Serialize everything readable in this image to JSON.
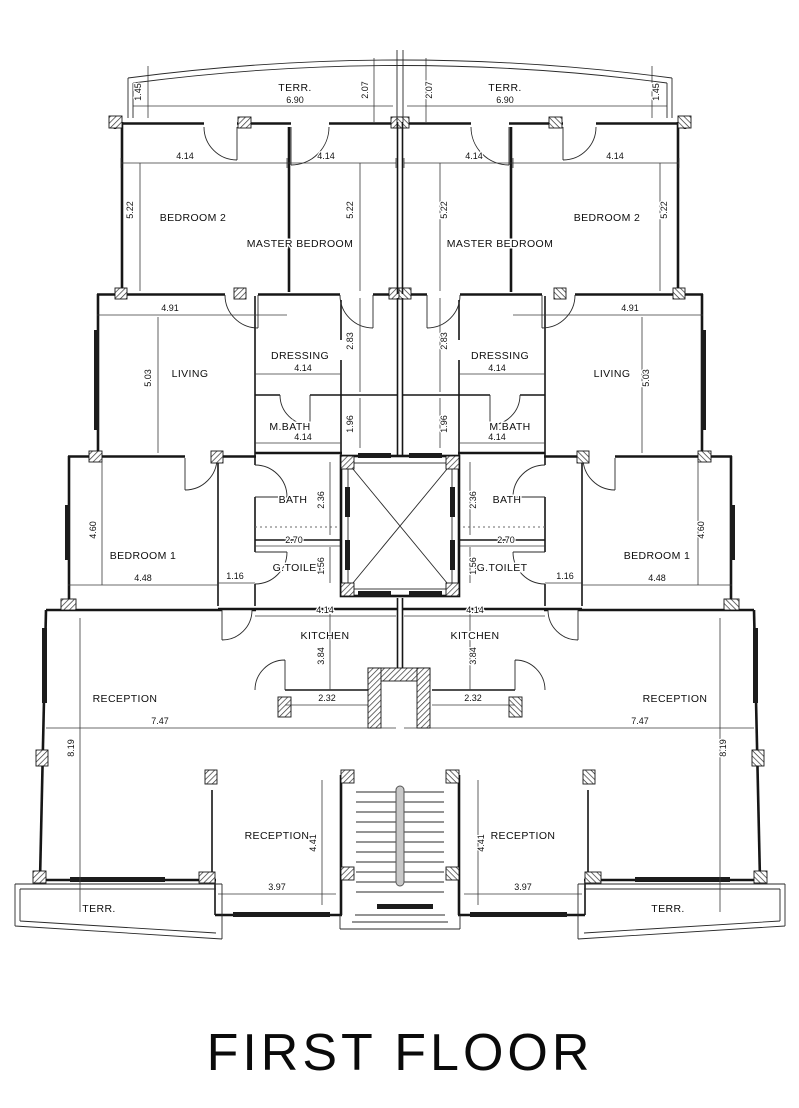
{
  "title": {
    "label": "FIRST FLOOR"
  },
  "colors": {
    "ink": "#161616",
    "paper": "#ffffff",
    "glass": "#1c1c1c"
  },
  "plan": {
    "rooms": [
      {
        "name": "room-label-terrace-top-left",
        "label": "TERR.",
        "x": 295,
        "y": 91
      },
      {
        "name": "room-label-terrace-top-right",
        "label": "TERR.",
        "x": 505,
        "y": 91
      },
      {
        "name": "room-label-bedroom2-left",
        "label": "BEDROOM 2",
        "x": 193,
        "y": 221
      },
      {
        "name": "room-label-bedroom2-right",
        "label": "BEDROOM 2",
        "x": 607,
        "y": 221
      },
      {
        "name": "room-label-master-bedroom-left",
        "label": "MASTER BEDROOM",
        "x": 300,
        "y": 247
      },
      {
        "name": "room-label-master-bedroom-right",
        "label": "MASTER BEDROOM",
        "x": 500,
        "y": 247
      },
      {
        "name": "room-label-living-left",
        "label": "LIVING",
        "x": 190,
        "y": 377
      },
      {
        "name": "room-label-living-right",
        "label": "LIVING",
        "x": 612,
        "y": 377
      },
      {
        "name": "room-label-dressing-left",
        "label": "DRESSING",
        "x": 300,
        "y": 359
      },
      {
        "name": "room-label-dressing-right",
        "label": "DRESSING",
        "x": 500,
        "y": 359
      },
      {
        "name": "room-label-mbath-left",
        "label": "M.BATH",
        "x": 290,
        "y": 430
      },
      {
        "name": "room-label-mbath-right",
        "label": "M.BATH",
        "x": 510,
        "y": 430
      },
      {
        "name": "room-label-bath-left",
        "label": "BATH",
        "x": 293,
        "y": 503
      },
      {
        "name": "room-label-bath-right",
        "label": "BATH",
        "x": 507,
        "y": 503
      },
      {
        "name": "room-label-gtoilet-left",
        "label": "G.TOILET",
        "x": 298,
        "y": 571
      },
      {
        "name": "room-label-gtoilet-right",
        "label": "G.TOILET",
        "x": 502,
        "y": 571
      },
      {
        "name": "room-label-bedroom1-left",
        "label": "BEDROOM 1",
        "x": 143,
        "y": 559
      },
      {
        "name": "room-label-bedroom1-right",
        "label": "BEDROOM 1",
        "x": 657,
        "y": 559
      },
      {
        "name": "room-label-kitchen-left",
        "label": "KITCHEN",
        "x": 325,
        "y": 639
      },
      {
        "name": "room-label-kitchen-right",
        "label": "KITCHEN",
        "x": 475,
        "y": 639
      },
      {
        "name": "room-label-reception-left",
        "label": "RECEPTION",
        "x": 125,
        "y": 702
      },
      {
        "name": "room-label-reception-right",
        "label": "RECEPTION",
        "x": 675,
        "y": 702
      },
      {
        "name": "room-label-reception-lower-left",
        "label": "RECEPTION",
        "x": 277,
        "y": 839
      },
      {
        "name": "room-label-reception-lower-right",
        "label": "RECEPTION",
        "x": 523,
        "y": 839
      },
      {
        "name": "room-label-terrace-bottom-left",
        "label": "TERR.",
        "x": 99,
        "y": 912
      },
      {
        "name": "room-label-terrace-bottom-right",
        "label": "TERR.",
        "x": 668,
        "y": 912
      }
    ],
    "dimensions": [
      {
        "label": "1.45",
        "x": 141,
        "y": 92,
        "rot": true
      },
      {
        "label": "1.45",
        "x": 659,
        "y": 92,
        "rot": true
      },
      {
        "label": "2.07",
        "x": 368,
        "y": 90,
        "rot": true
      },
      {
        "label": "2.07",
        "x": 432,
        "y": 90,
        "rot": true
      },
      {
        "label": "6.90",
        "x": 295,
        "y": 103
      },
      {
        "label": "6.90",
        "x": 505,
        "y": 103
      },
      {
        "label": "4.14",
        "x": 185,
        "y": 159
      },
      {
        "label": "4.14",
        "x": 326,
        "y": 159
      },
      {
        "label": "4.14",
        "x": 474,
        "y": 159
      },
      {
        "label": "4.14",
        "x": 615,
        "y": 159
      },
      {
        "label": "5.22",
        "x": 133,
        "y": 210,
        "rot": true
      },
      {
        "label": "5.22",
        "x": 353,
        "y": 210,
        "rot": true
      },
      {
        "label": "5.22",
        "x": 447,
        "y": 210,
        "rot": true
      },
      {
        "label": "5.22",
        "x": 667,
        "y": 210,
        "rot": true
      },
      {
        "label": "4.91",
        "x": 170,
        "y": 311
      },
      {
        "label": "4.91",
        "x": 630,
        "y": 311
      },
      {
        "label": "5.03",
        "x": 151,
        "y": 378,
        "rot": true
      },
      {
        "label": "5.03",
        "x": 649,
        "y": 378,
        "rot": true
      },
      {
        "label": "2.83",
        "x": 353,
        "y": 341,
        "rot": true
      },
      {
        "label": "2.83",
        "x": 447,
        "y": 341,
        "rot": true
      },
      {
        "label": "4.14",
        "x": 303,
        "y": 371
      },
      {
        "label": "4.14",
        "x": 497,
        "y": 371
      },
      {
        "label": "1.96",
        "x": 353,
        "y": 424,
        "rot": true
      },
      {
        "label": "1.96",
        "x": 447,
        "y": 424,
        "rot": true
      },
      {
        "label": "4.14",
        "x": 303,
        "y": 440
      },
      {
        "label": "4.14",
        "x": 497,
        "y": 440
      },
      {
        "label": "2.36",
        "x": 324,
        "y": 500,
        "rot": true
      },
      {
        "label": "2.36",
        "x": 476,
        "y": 500,
        "rot": true
      },
      {
        "label": "4.60",
        "x": 96,
        "y": 530,
        "rot": true
      },
      {
        "label": "4.60",
        "x": 704,
        "y": 530,
        "rot": true
      },
      {
        "label": "2.70",
        "x": 294,
        "y": 543
      },
      {
        "label": "2.70",
        "x": 506,
        "y": 543
      },
      {
        "label": "1.56",
        "x": 324,
        "y": 566,
        "rot": true
      },
      {
        "label": "1.56",
        "x": 476,
        "y": 566,
        "rot": true
      },
      {
        "label": "1.16",
        "x": 235,
        "y": 579
      },
      {
        "label": "1.16",
        "x": 565,
        "y": 579
      },
      {
        "label": "4.48",
        "x": 143,
        "y": 581
      },
      {
        "label": "4.48",
        "x": 657,
        "y": 581
      },
      {
        "label": "4.14",
        "x": 325,
        "y": 613
      },
      {
        "label": "4.14",
        "x": 475,
        "y": 613
      },
      {
        "label": "3.84",
        "x": 324,
        "y": 656,
        "rot": true
      },
      {
        "label": "3.84",
        "x": 476,
        "y": 656,
        "rot": true
      },
      {
        "label": "2.32",
        "x": 327,
        "y": 701
      },
      {
        "label": "2.32",
        "x": 473,
        "y": 701
      },
      {
        "label": "7.47",
        "x": 160,
        "y": 724
      },
      {
        "label": "7.47",
        "x": 640,
        "y": 724
      },
      {
        "label": "8.19",
        "x": 74,
        "y": 748,
        "rot": true
      },
      {
        "label": "8.19",
        "x": 726,
        "y": 748,
        "rot": true
      },
      {
        "label": "4.41",
        "x": 316,
        "y": 843,
        "rot": true
      },
      {
        "label": "4.41",
        "x": 484,
        "y": 843,
        "rot": true
      },
      {
        "label": "3.97",
        "x": 277,
        "y": 890
      },
      {
        "label": "3.97",
        "x": 523,
        "y": 890
      }
    ]
  }
}
